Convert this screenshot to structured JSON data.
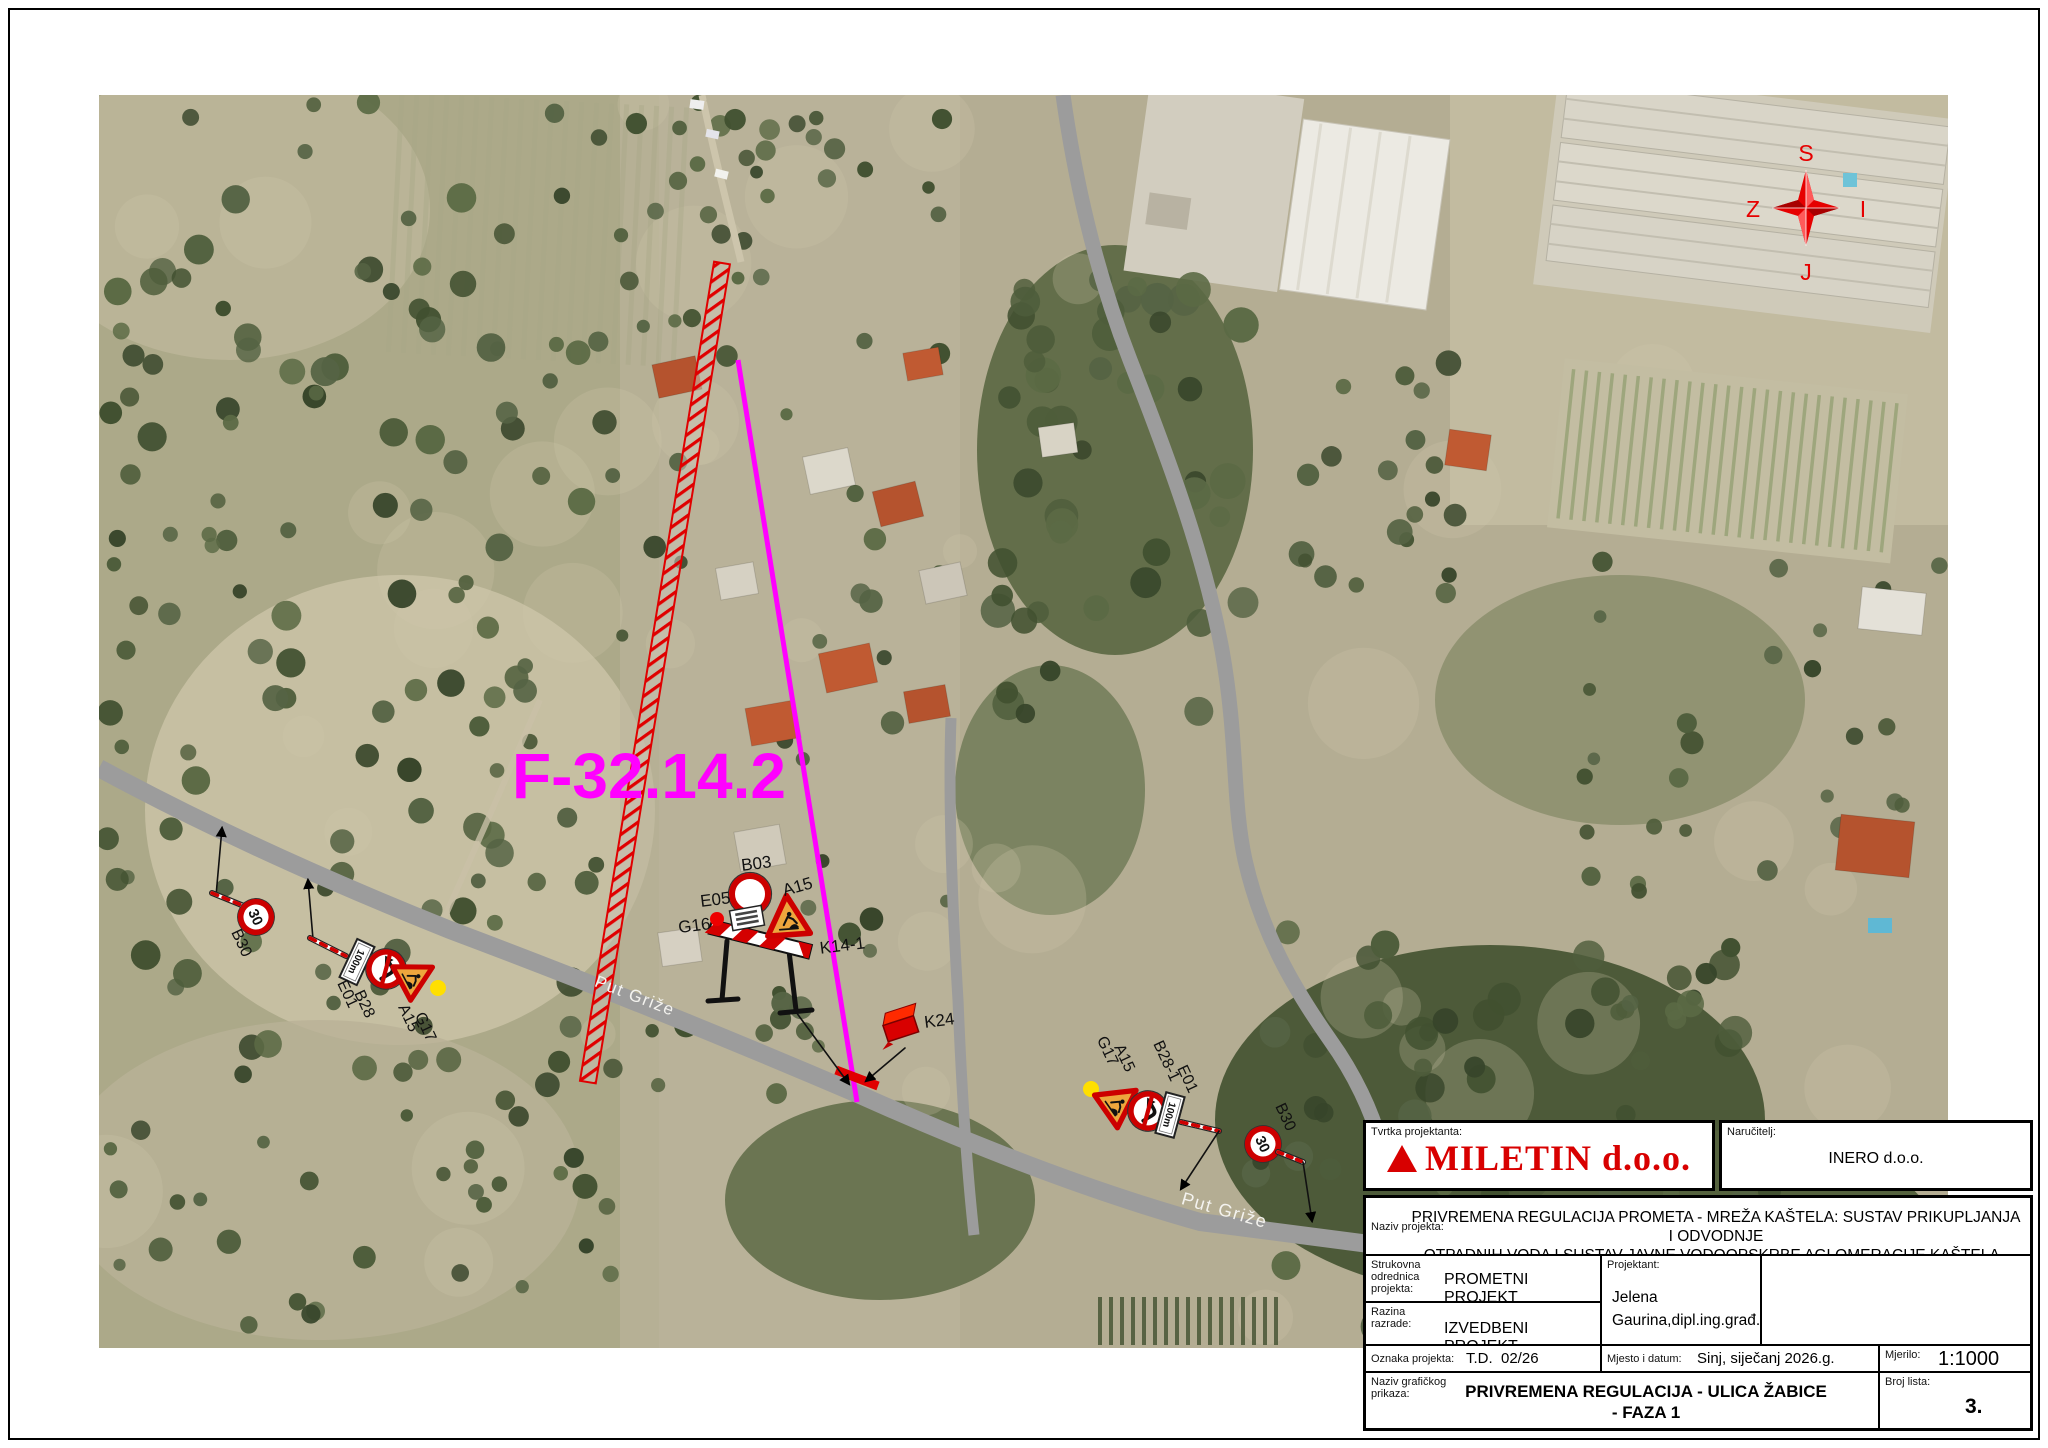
{
  "map": {
    "colors": {
      "accent_red": "#cc0000",
      "works_magenta": "#ff00ff",
      "road_gray": "#9c9c9c",
      "lamp_yellow": "#ffdf00"
    },
    "works_label": "F-32.14.2",
    "road_name_1": "Put Griže",
    "road_name_2": "Put Griže",
    "compass": {
      "n": "S",
      "e": "I",
      "s": "J",
      "w": "Z"
    },
    "signs": {
      "b03": "B03",
      "a15_center": "A15",
      "e05": "E05",
      "g16": "G16",
      "k14": "K14-1",
      "k24": "K24",
      "left_b30": "B30",
      "left_e01": "E01",
      "left_b28": "B28",
      "left_a15": "A15",
      "left_g17": "G17",
      "right_g17": "G17",
      "right_a15": "A15",
      "right_b28": "B28-1",
      "right_e01": "E01",
      "right_b30": "B30",
      "speed_30": "30",
      "dist_100m": "100m"
    }
  },
  "titleblock": {
    "tvrtka_label": "Tvrtka projektanta:",
    "logo_text": "MILETIN d.o.o.",
    "narucitelj_label": "Naručitelj:",
    "narucitelj": "INERO d.o.o.",
    "naziv_label": "Naziv projekta:",
    "naziv_line1": "PRIVREMENA REGULACIJA PROMETA - MREŽA KAŠTELA: SUSTAV PRIKUPLJANJA I ODVODNJE",
    "naziv_line2": "OTPADNIH VODA I SUSTAV JAVNE VODOOPSKRBE AGLOMERACIJE KAŠTELA -TROGIR",
    "strukovna_label": "Strukovna odrednica projekta:",
    "strukovna": "PROMETNI PROJEKT",
    "razina_label": "Razina razrade:",
    "razina": "IZVEDBENI PROJEKT",
    "projektant_label": "Projektant:",
    "projektant_line1": "Jelena",
    "projektant_line2": "Gaurina,dipl.ing.građ.",
    "oznaka_label": "Oznaka projekta:",
    "oznaka": "T.D.  02/26",
    "mjesto_label": "Mjesto i datum:",
    "mjesto": "Sinj, siječanj 2026.g.",
    "mjerilo_label": "Mjerilo:",
    "mjerilo": "1:1000",
    "naziv_graf_label1": "Naziv grafičkog",
    "naziv_graf_label2": "prikaza:",
    "naziv_graf_line1": "PRIVREMENA REGULACIJA - ULICA ŽABICE",
    "naziv_graf_line2": "- FAZA 1",
    "broj_label": "Broj lista:",
    "broj": "3."
  }
}
